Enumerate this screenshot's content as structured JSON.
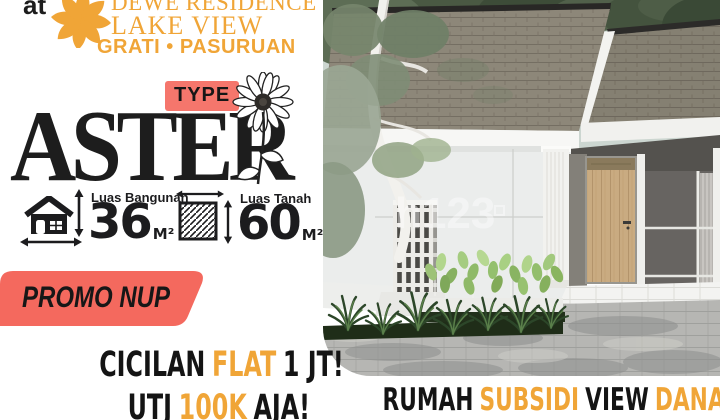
{
  "brand": {
    "prefix": "at",
    "line1": "DEWE RESIDENCE",
    "line2": "LAKE VIEW",
    "location": "GRATI • PASURUAN"
  },
  "type": {
    "badge": "TYPE",
    "name": "ASTER"
  },
  "specs": {
    "building": {
      "label": "Luas Bangunan",
      "value": "36",
      "unit": "M²"
    },
    "land": {
      "label": "Luas Tanah",
      "value": "60",
      "unit": "M²"
    }
  },
  "promo": {
    "label": "PROMO NUP"
  },
  "headline": {
    "l1a": "CICILAN",
    "l1b": "FLAT",
    "l1c": "1 JT!",
    "l2a": "UTJ",
    "l2b": "100K",
    "l2c": "AJA!"
  },
  "tagline": {
    "a": "RUMAH",
    "b": "SUBSIDI",
    "c": "VIEW",
    "d": "DANAU"
  },
  "watermark": "h123",
  "icons": {
    "logo": "leaf-rosette-icon",
    "flower": "aster-daisy-icon",
    "building": "house-icon",
    "land": "hatched-square-icon",
    "arrows": "double-arrow-icon"
  },
  "colors": {
    "orange": "#F0A537",
    "coral_badge": "#F5766C",
    "coral_banner": "#F4695E",
    "ink": "#1C1C1E"
  }
}
